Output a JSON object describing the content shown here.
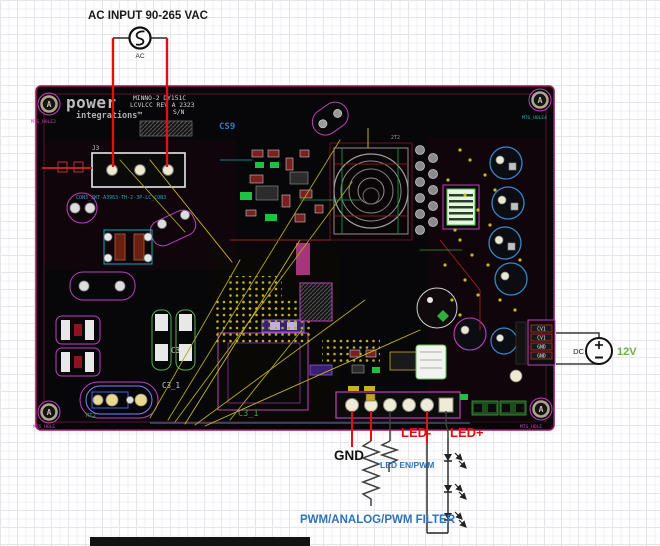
{
  "annotations": {
    "title": "AC INPUT 90-265 VAC",
    "ac_label": "AC",
    "dc_label": "DC",
    "voltage": "12V",
    "gnd": "GND",
    "led_en_pwm": "LED EN/PWM",
    "led_minus": "LED-",
    "led_plus": "LED+",
    "pwm_filter": "PWM/ANALOG/PWM FILTER"
  },
  "pcb": {
    "logo": {
      "line1": "power",
      "line2": "integrations™"
    },
    "board_id": {
      "line1": "MINNO-2 DY151C",
      "line2": "LCVLCC  REV A 2323",
      "line3": "S/N"
    },
    "refdes": {
      "cs9": "CS9",
      "j3": "J3",
      "con3": "CON3_JWT-A3963-TH-2-3P-LC_CON3",
      "c3": "C3",
      "c3_1": "C3_1",
      "c3_1_green": "C3_1",
      "t2": "2T2",
      "rt2": "RT2"
    },
    "mounting_holes": {
      "letter": "A",
      "label_tl": "MTG_HOLE2",
      "label_tr": "MTG_HOLE4",
      "label_bl": "MTG_HOLE",
      "label_br": "MTG_HOLE"
    },
    "output_connector": {
      "pins": [
        "CV1",
        "CV1",
        "GND",
        "GND"
      ]
    }
  },
  "colors": {
    "annotation_blue": "#2e74b5",
    "annotation_red": "#e01010",
    "voltage_green": "#70ad47",
    "board_black": "#070608",
    "board_outline": "#a2155c",
    "silkscreen_white": "#d8d8d8",
    "trace_yellow": "#bfae1e",
    "outline_magenta": "#c040c0",
    "cap_blue": "#3888c8"
  }
}
